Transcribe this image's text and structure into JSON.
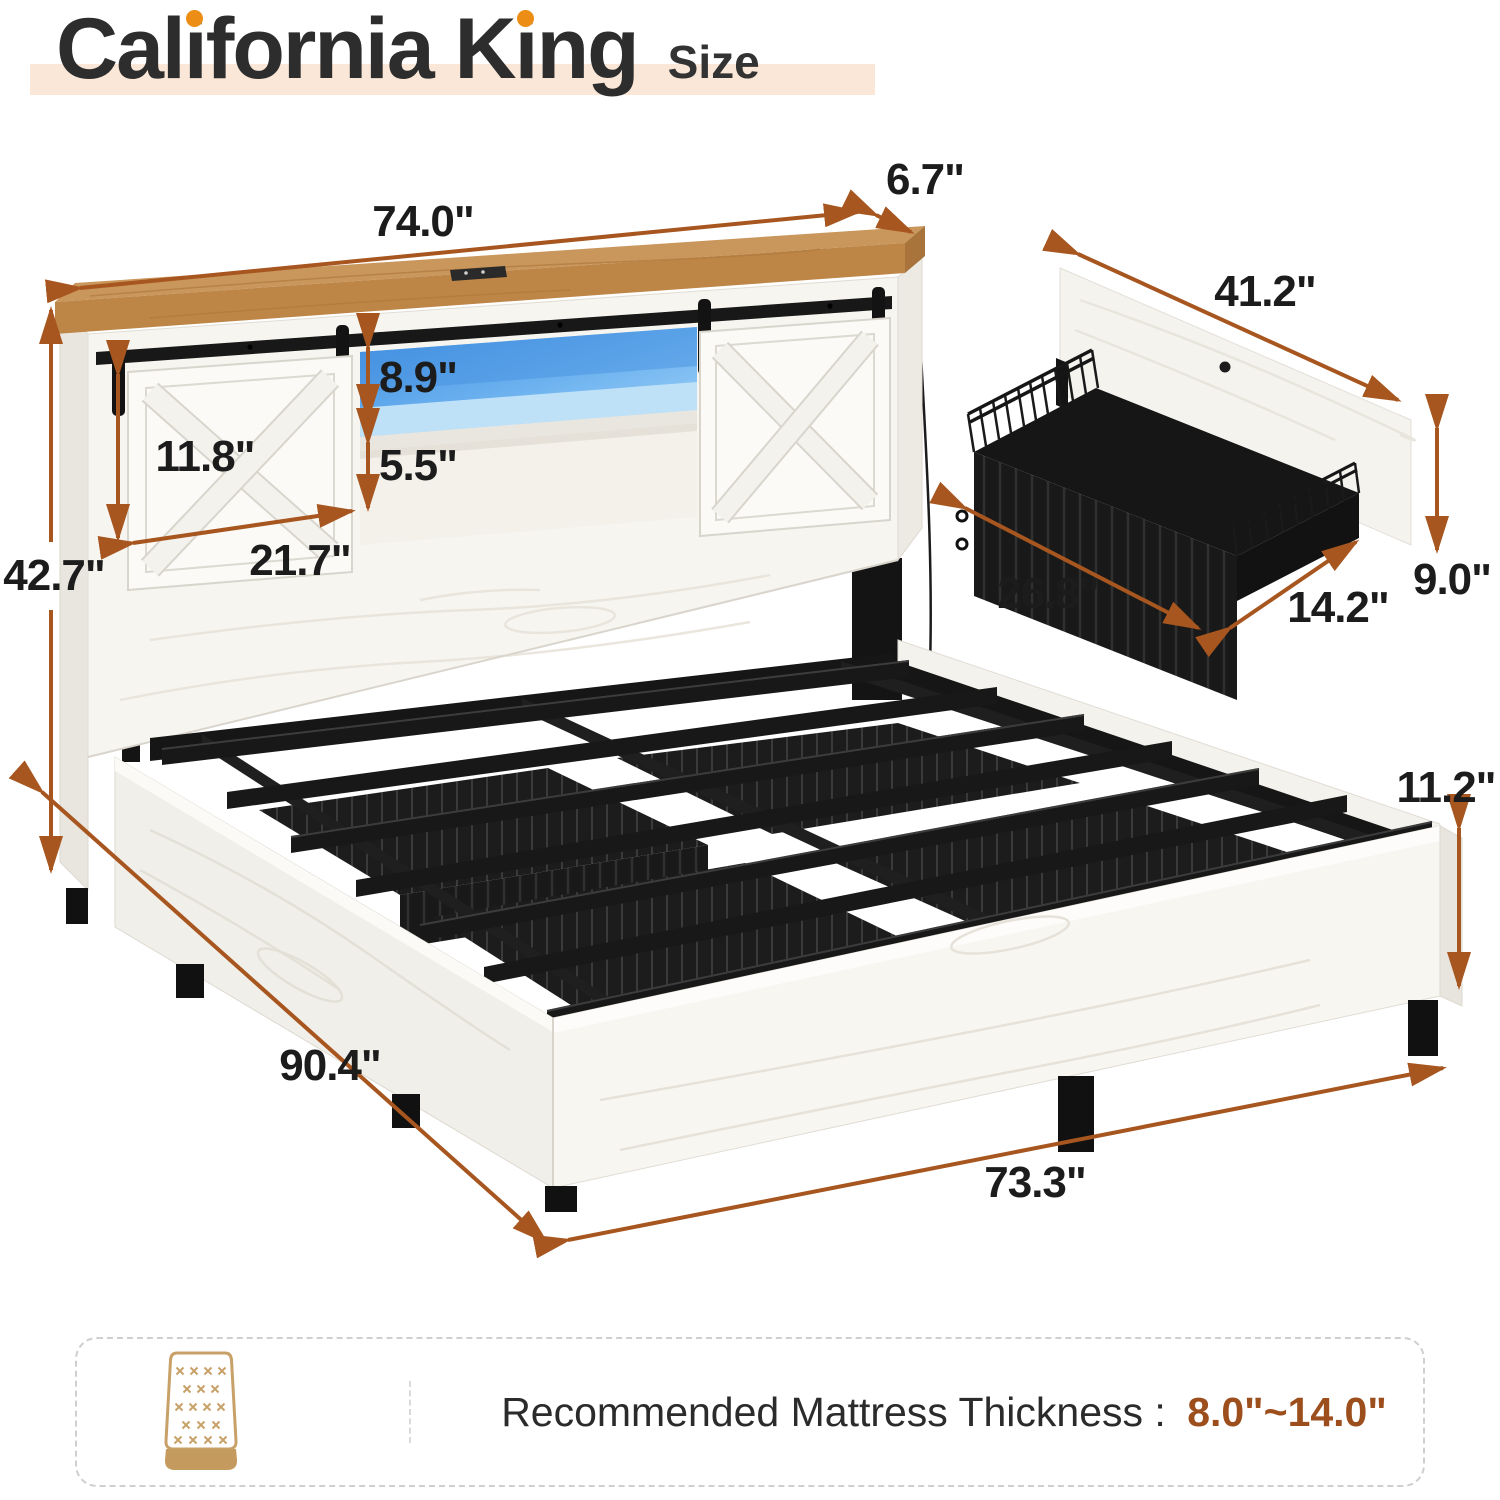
{
  "title": {
    "text": "California King",
    "parts": [
      {
        "t": "Cal"
      },
      {
        "t": "i"
      },
      {
        "t": "fornia"
      },
      {
        "t": " K"
      },
      {
        "t": "i"
      },
      {
        "t": "ng"
      }
    ],
    "size_label": "Size"
  },
  "dimensions": {
    "headboard_width": "74.0\"",
    "headboard_depth": "6.7\"",
    "led_shelf_height": "8.9\"",
    "barn_door_height": "11.8\"",
    "lower_shelf_height": "5.5\"",
    "barn_door_width": "21.7\"",
    "headboard_height": "42.7\"",
    "panel_width": "41.2\"",
    "basket_width": "26.8\"",
    "panel_height": "9.0\"",
    "basket_depth": "14.2\"",
    "frame_height": "11.2\"",
    "bed_length": "90.4\"",
    "bed_width": "73.3\""
  },
  "footer": {
    "label": "Recommended Mattress Thickness : ",
    "value": "8.0\"~14.0\"",
    "icon": "mattress-icon"
  },
  "colors": {
    "accent_orange": "#ec8d15",
    "arrow_brown": "#a7561f",
    "value_brown": "#9c4f1d",
    "led_blue": "#4f9ce8",
    "wood_tan": "#c9965c",
    "peach_highlight": "#fae7d8"
  }
}
